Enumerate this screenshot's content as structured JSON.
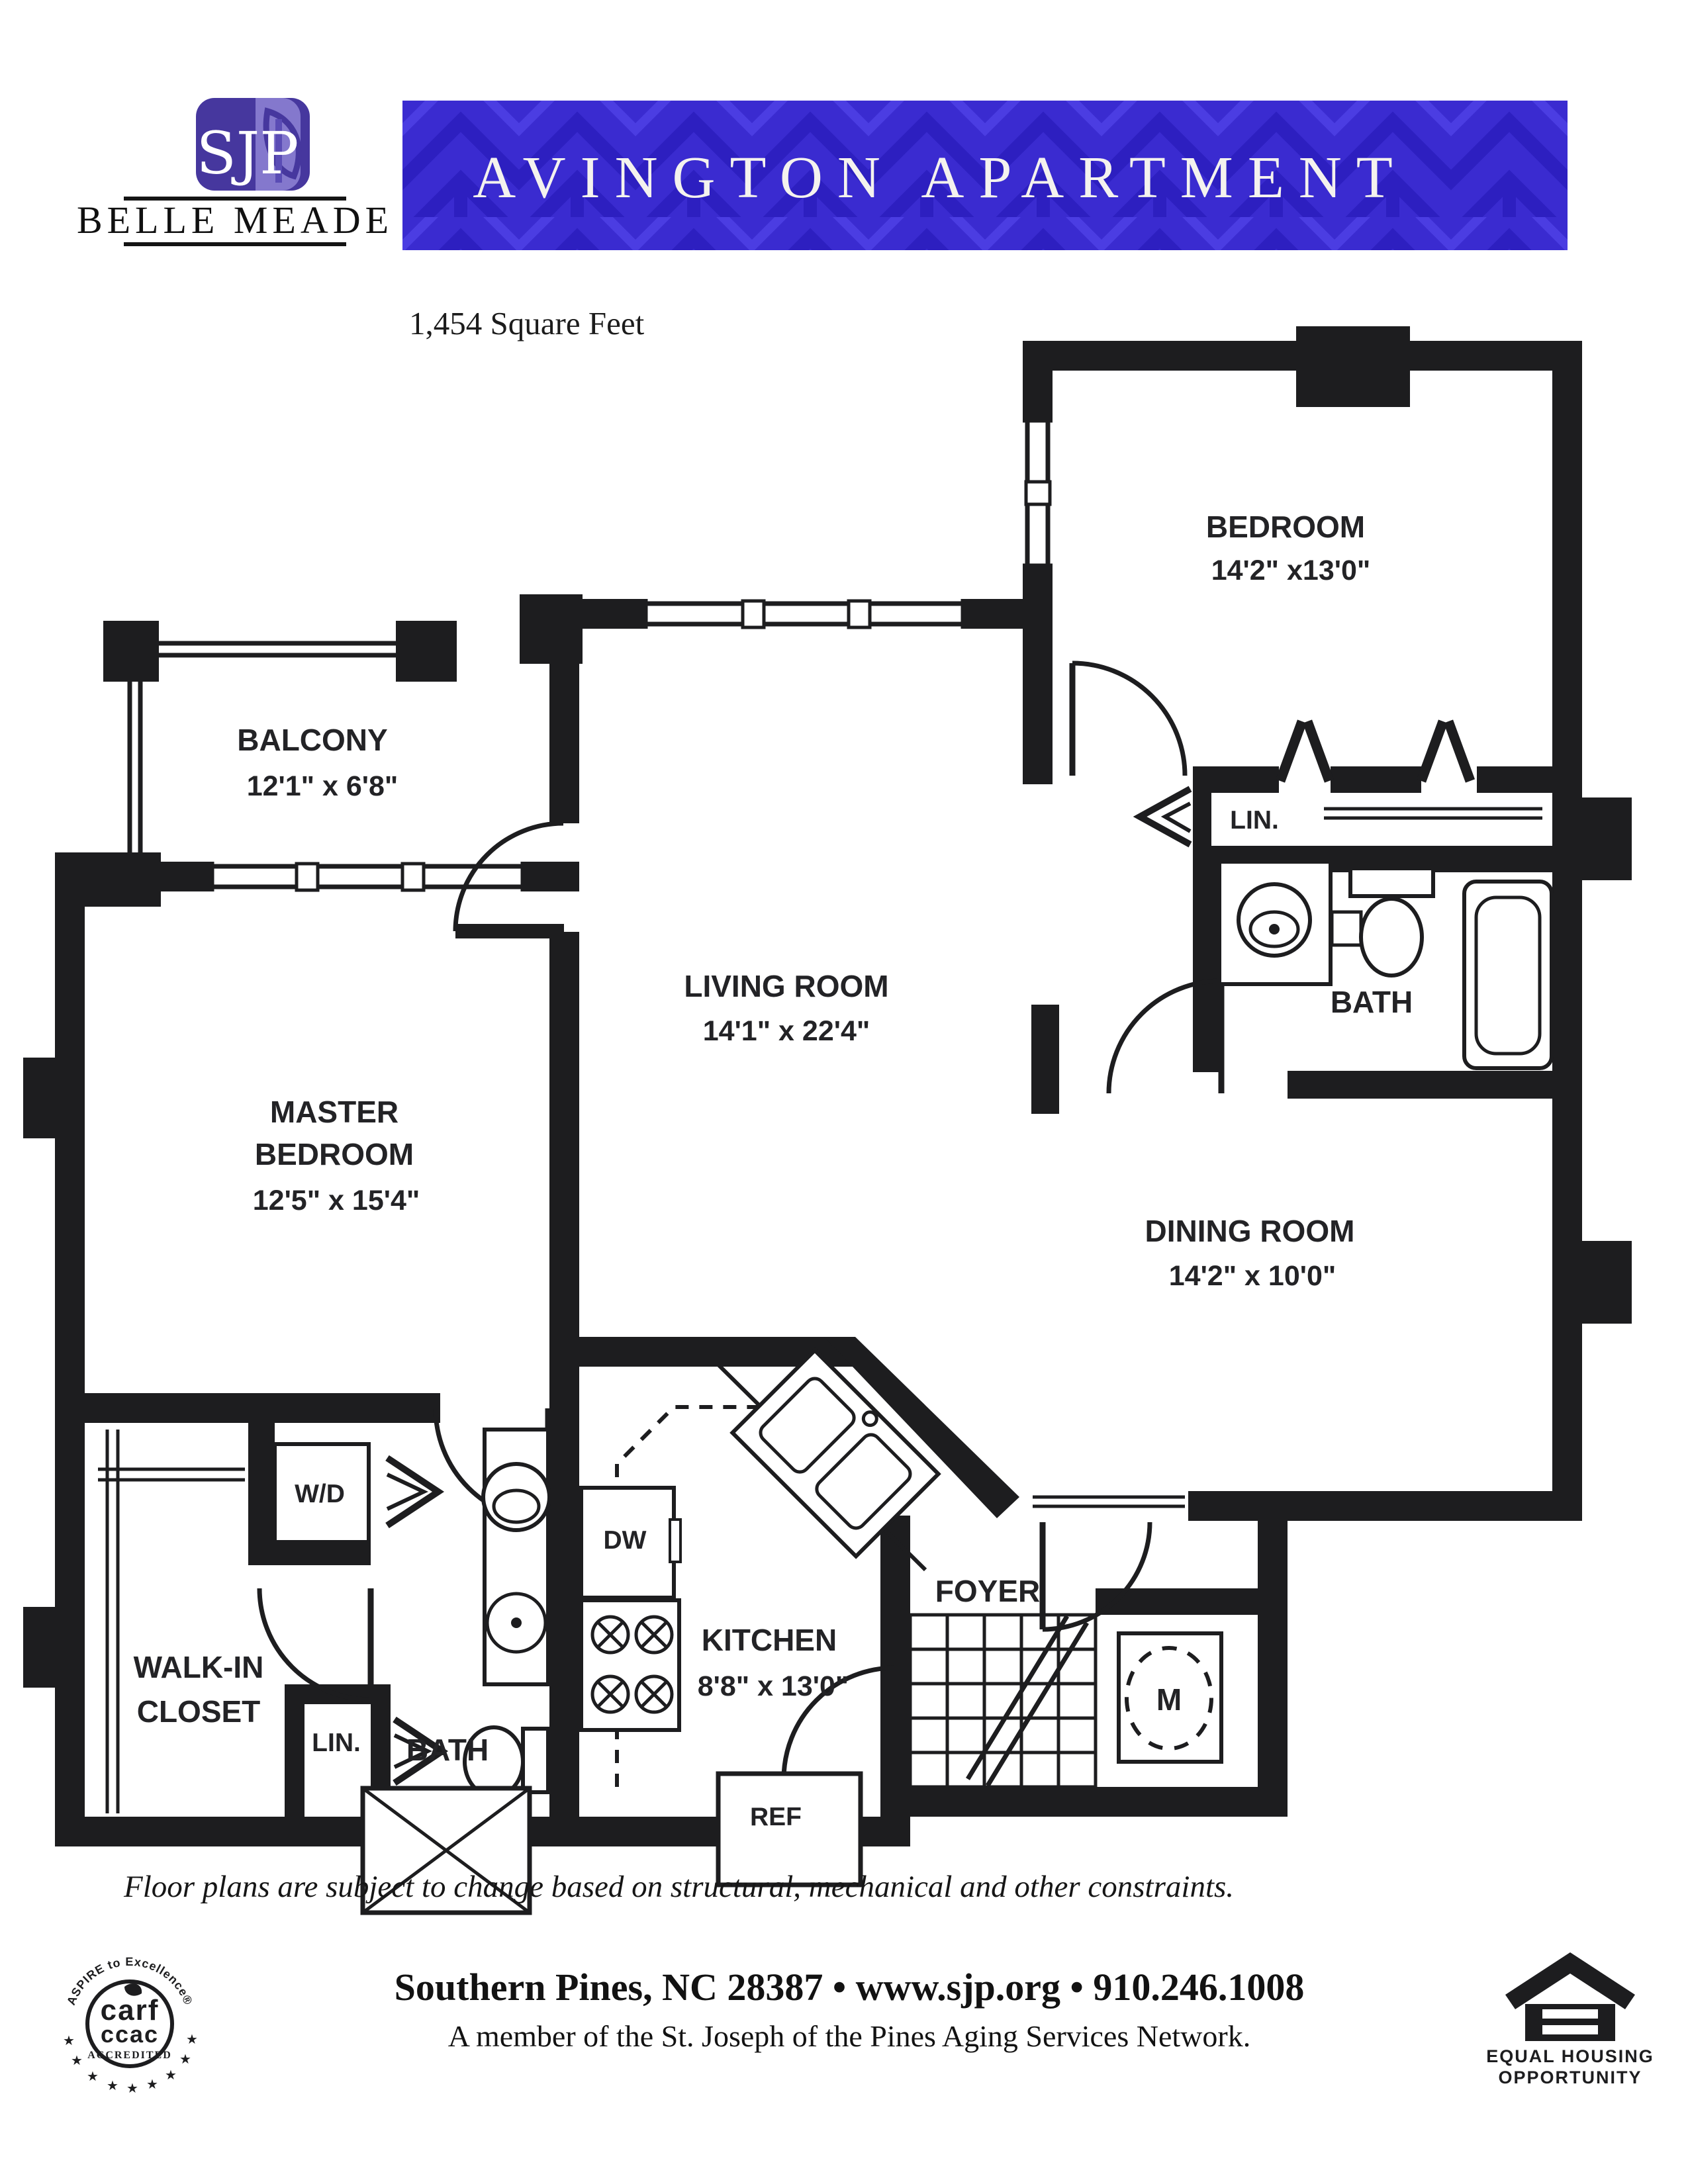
{
  "header": {
    "logo_text": "SJP",
    "brand": "BELLE MEADE",
    "banner_title": "AVINGTON APARTMENT",
    "area": "1,454 Square Feet"
  },
  "plan": {
    "bedroom": {
      "name": "BEDROOM",
      "dims": "14'2\" x13'0\""
    },
    "balcony": {
      "name": "BALCONY",
      "dims": "12'1\" x 6'8\""
    },
    "living": {
      "name": "LIVING ROOM",
      "dims": "14'1\" x 22'4\""
    },
    "master": {
      "name1": "MASTER",
      "name2": "BEDROOM",
      "dims": "12'5\" x 15'4\""
    },
    "dining": {
      "name": "DINING ROOM",
      "dims": "14'2\" x 10'0\""
    },
    "kitchen": {
      "name": "KITCHEN",
      "dims": "8'8\" x 13'0\""
    },
    "bath_upper": "BATH",
    "bath_lower": "BATH",
    "lin_upper": "LIN.",
    "lin_lower": "LIN.",
    "walkin": {
      "name1": "WALK-IN",
      "name2": "CLOSET"
    },
    "foyer": "FOYER",
    "wd": "W/D",
    "dw": "DW",
    "ref": "REF",
    "mech": "M"
  },
  "footer": {
    "disclaimer": "Floor plans are subject to change based on structural, mechanical and other constraints.",
    "contact": "Southern Pines, NC 28387  •  www.sjp.org  •  910.246.1008",
    "membership": "A member of the St. Joseph of the Pines Aging Services Network."
  },
  "seals": {
    "carf_arc": "ASPIRE to Excellence®",
    "carf_1": "carf",
    "carf_2": "ccac",
    "carf_3": "ACCREDITED",
    "eho_1": "EQUAL HOUSING",
    "eho_2": "OPPORTUNITY"
  },
  "colors": {
    "banner_bg": "#3a2bd0",
    "banner_pattern_dark": "#2d1fc0",
    "banner_pattern_light": "#4b3de2",
    "wall": "#1d1d1f",
    "logo_purple": "#46379e"
  }
}
